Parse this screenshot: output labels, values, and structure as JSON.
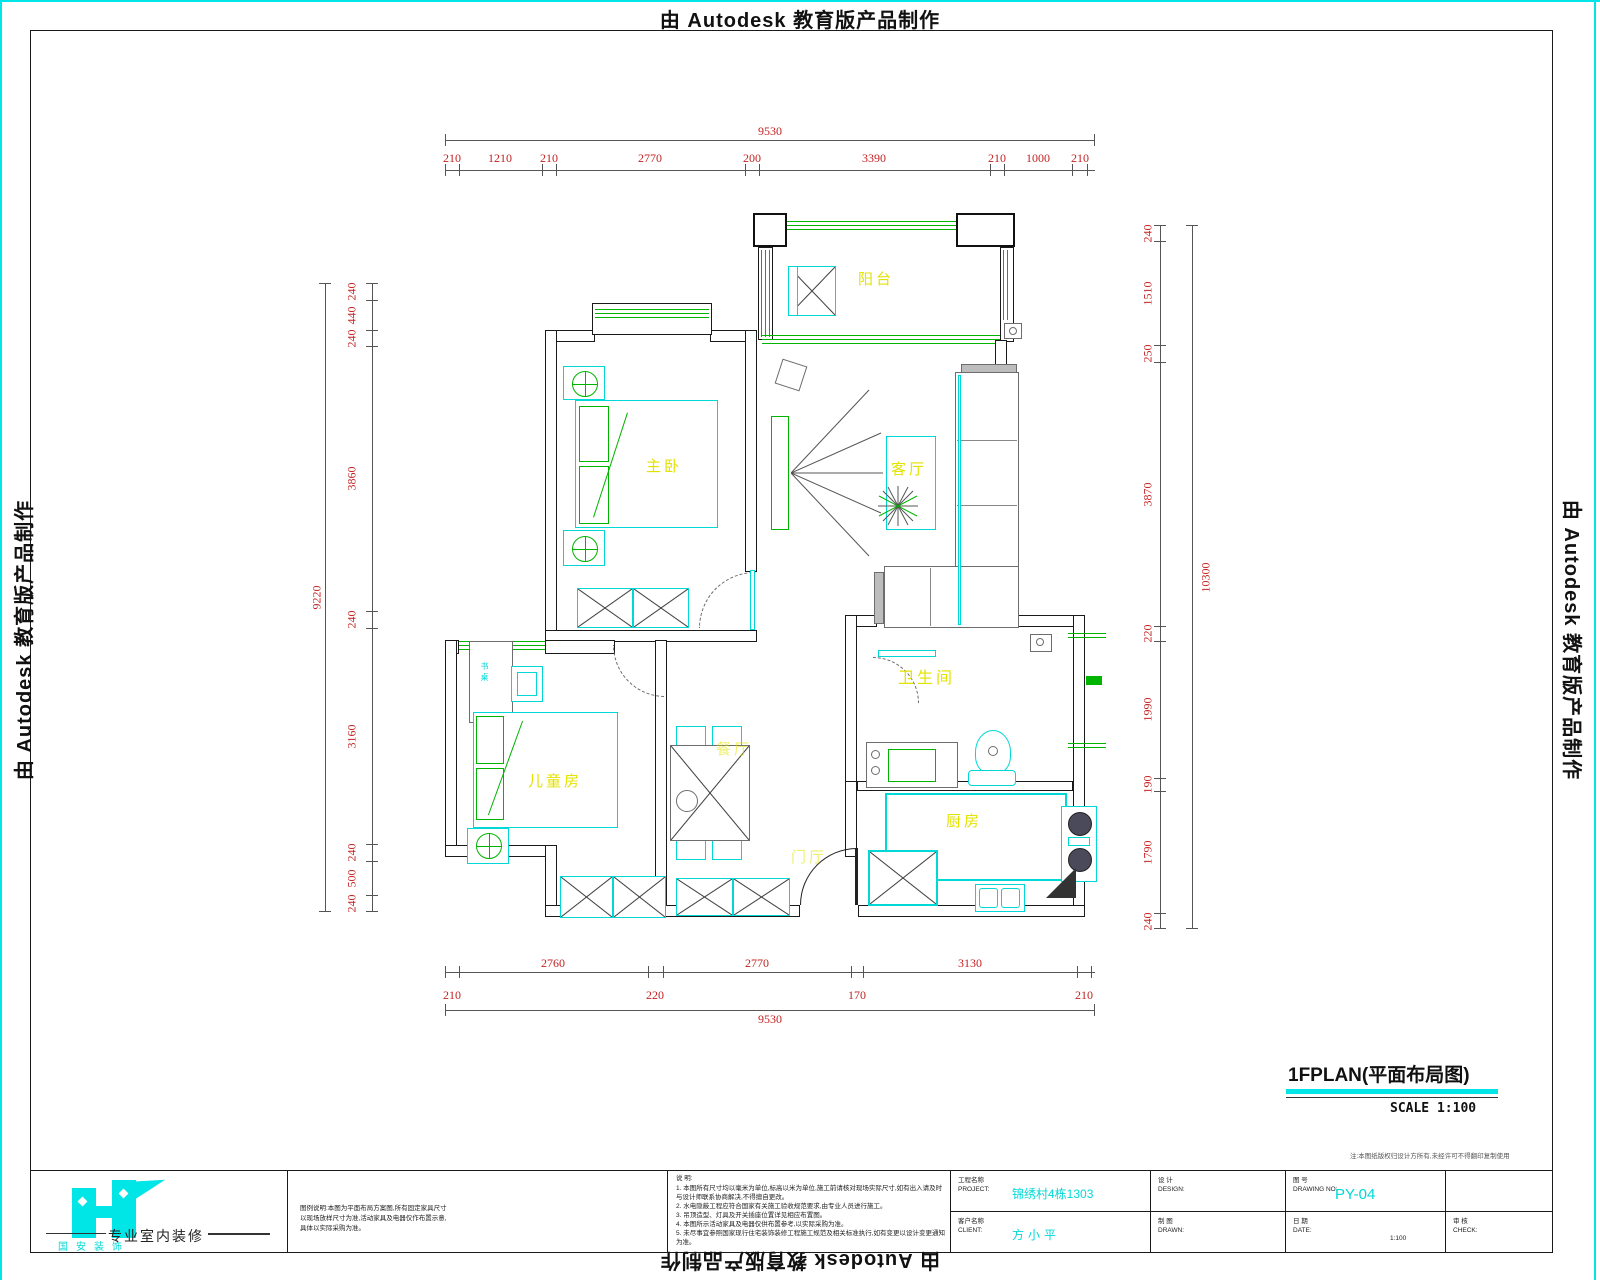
{
  "watermark": {
    "text": "由 Autodesk 教育版产品制作"
  },
  "title": {
    "name": "1FPLAN(平面布局图)",
    "scale": "SCALE  1:100",
    "copyright_note": "注:本图纸版权归设计方所有,未经许可不得翻印复制使用"
  },
  "logo": {
    "company": "国安装饰",
    "tagline": "专业室内装修"
  },
  "rooms": {
    "balcony": "阳台",
    "master": "主卧",
    "living": "客厅",
    "kids": "儿童房",
    "dining": "餐厅",
    "bath": "卫生间",
    "kitchen": "厨房",
    "foyer": "门厅",
    "desk": "书桌"
  },
  "dims": {
    "top": {
      "overall": "9530",
      "segments": [
        "210",
        "1210",
        "210",
        "2770",
        "200",
        "3390",
        "210",
        "1000",
        "210"
      ]
    },
    "bottom": {
      "overall": "9530",
      "row1": [
        "2760",
        "2770",
        "3130"
      ],
      "row2": [
        "210",
        "220",
        "170",
        "210"
      ]
    },
    "left": {
      "overall": "9220",
      "segments": [
        "240",
        "440",
        "240",
        "3860",
        "240",
        "3160",
        "240",
        "500",
        "240"
      ]
    },
    "right": {
      "overall": "10300",
      "segments": [
        "240",
        "1510",
        "250",
        "3870",
        "220",
        "1990",
        "190",
        "1790",
        "240"
      ]
    }
  },
  "titleblock": {
    "legend_lines": [
      "图例说明:本图为平面布局方案图,所有固定家具尺寸",
      "以现场放样尺寸为准,活动家具及电器仅作布置示意,",
      "具体以实际采购为准。"
    ],
    "notes_heading": "说  明:",
    "notes_lines": [
      "1. 本图所有尺寸均以毫米为单位,标高以米为单位,施工前请核对现场实际尺寸,如有出入请及时",
      "   与设计师联系协商解决,不得擅自更改。",
      "2. 水电隐蔽工程应符合国家有关施工验收规范要求,由专业人员进行施工。",
      "3. 吊顶造型、灯具及开关插座位置详见相应布置图。",
      "4. 本图所示活动家具及电器仅供布置参考,以实际采购为准。",
      "5. 未尽事宜参照国家现行住宅装饰装修工程施工规范及相关标准执行,如有变更以设计变更通知",
      "   为准。"
    ],
    "fields": {
      "project_label": "工程名称",
      "project_label_en": "PROJECT:",
      "project_value": "锦绣村4栋1303",
      "client_label": "客户名称",
      "client_label_en": "CLIENT:",
      "client_value": "方小平",
      "design_label": "设  计",
      "design_label_en": "DESIGN:",
      "drawn_label": "制  图",
      "drawn_label_en": "DRAWN:",
      "drawingno_label": "图  号",
      "drawingno_label_en": "DRAWING NO:",
      "drawingno_value": "PY-04",
      "date_label": "日  期",
      "date_label_en": "DATE:",
      "date_value": "1:100",
      "check_label": "审 核",
      "check_label_en": "CHECK:"
    }
  }
}
